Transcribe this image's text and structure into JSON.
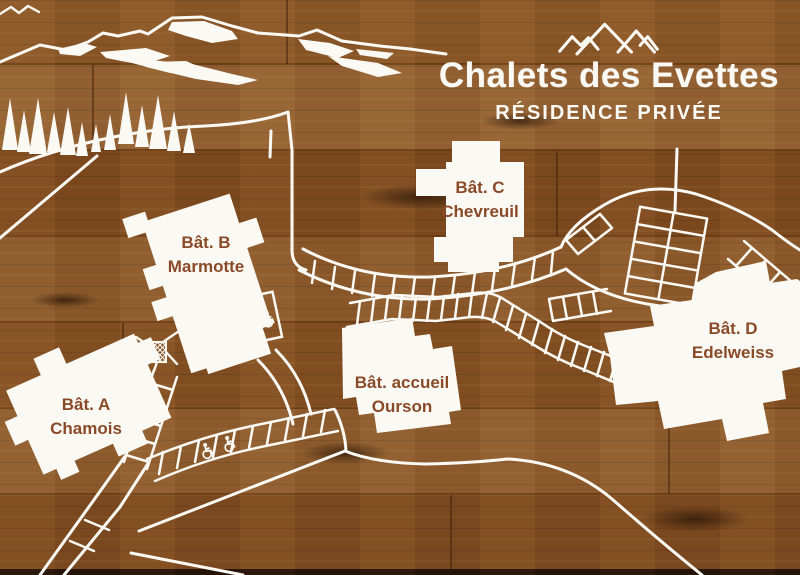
{
  "header": {
    "title": "Chalets des Evettes",
    "subtitle": "RÉSIDENCE PRIVÉE",
    "logo_icon": "three-mountain-peaks-icon"
  },
  "buildings": [
    {
      "id": "A",
      "line1": "Bât. A",
      "line2": "Chamois"
    },
    {
      "id": "B",
      "line1": "Bât. B",
      "line2": "Marmotte"
    },
    {
      "id": "C",
      "line1": "Bât. C",
      "line2": "Chevreuil"
    },
    {
      "id": "D",
      "line1": "Bât. D",
      "line2": "Edelweiss"
    },
    {
      "id": "accueil",
      "line1": "Bât. accueil",
      "line2": "Ourson"
    }
  ],
  "map_features": {
    "decorations": [
      "mountain-range-with-snow",
      "pine-trees"
    ],
    "accessible_parking_icon": "wheelchair-icon",
    "accessible_parking_spots": 6,
    "technical_structure": "crosshatched-square",
    "surface": "engraved-wood-panel"
  },
  "colors": {
    "wood_base": "#8a5526",
    "engraving_white": "#fbf9f4",
    "label_brown": "#8a4a28",
    "bottom_edge": "#241307"
  }
}
